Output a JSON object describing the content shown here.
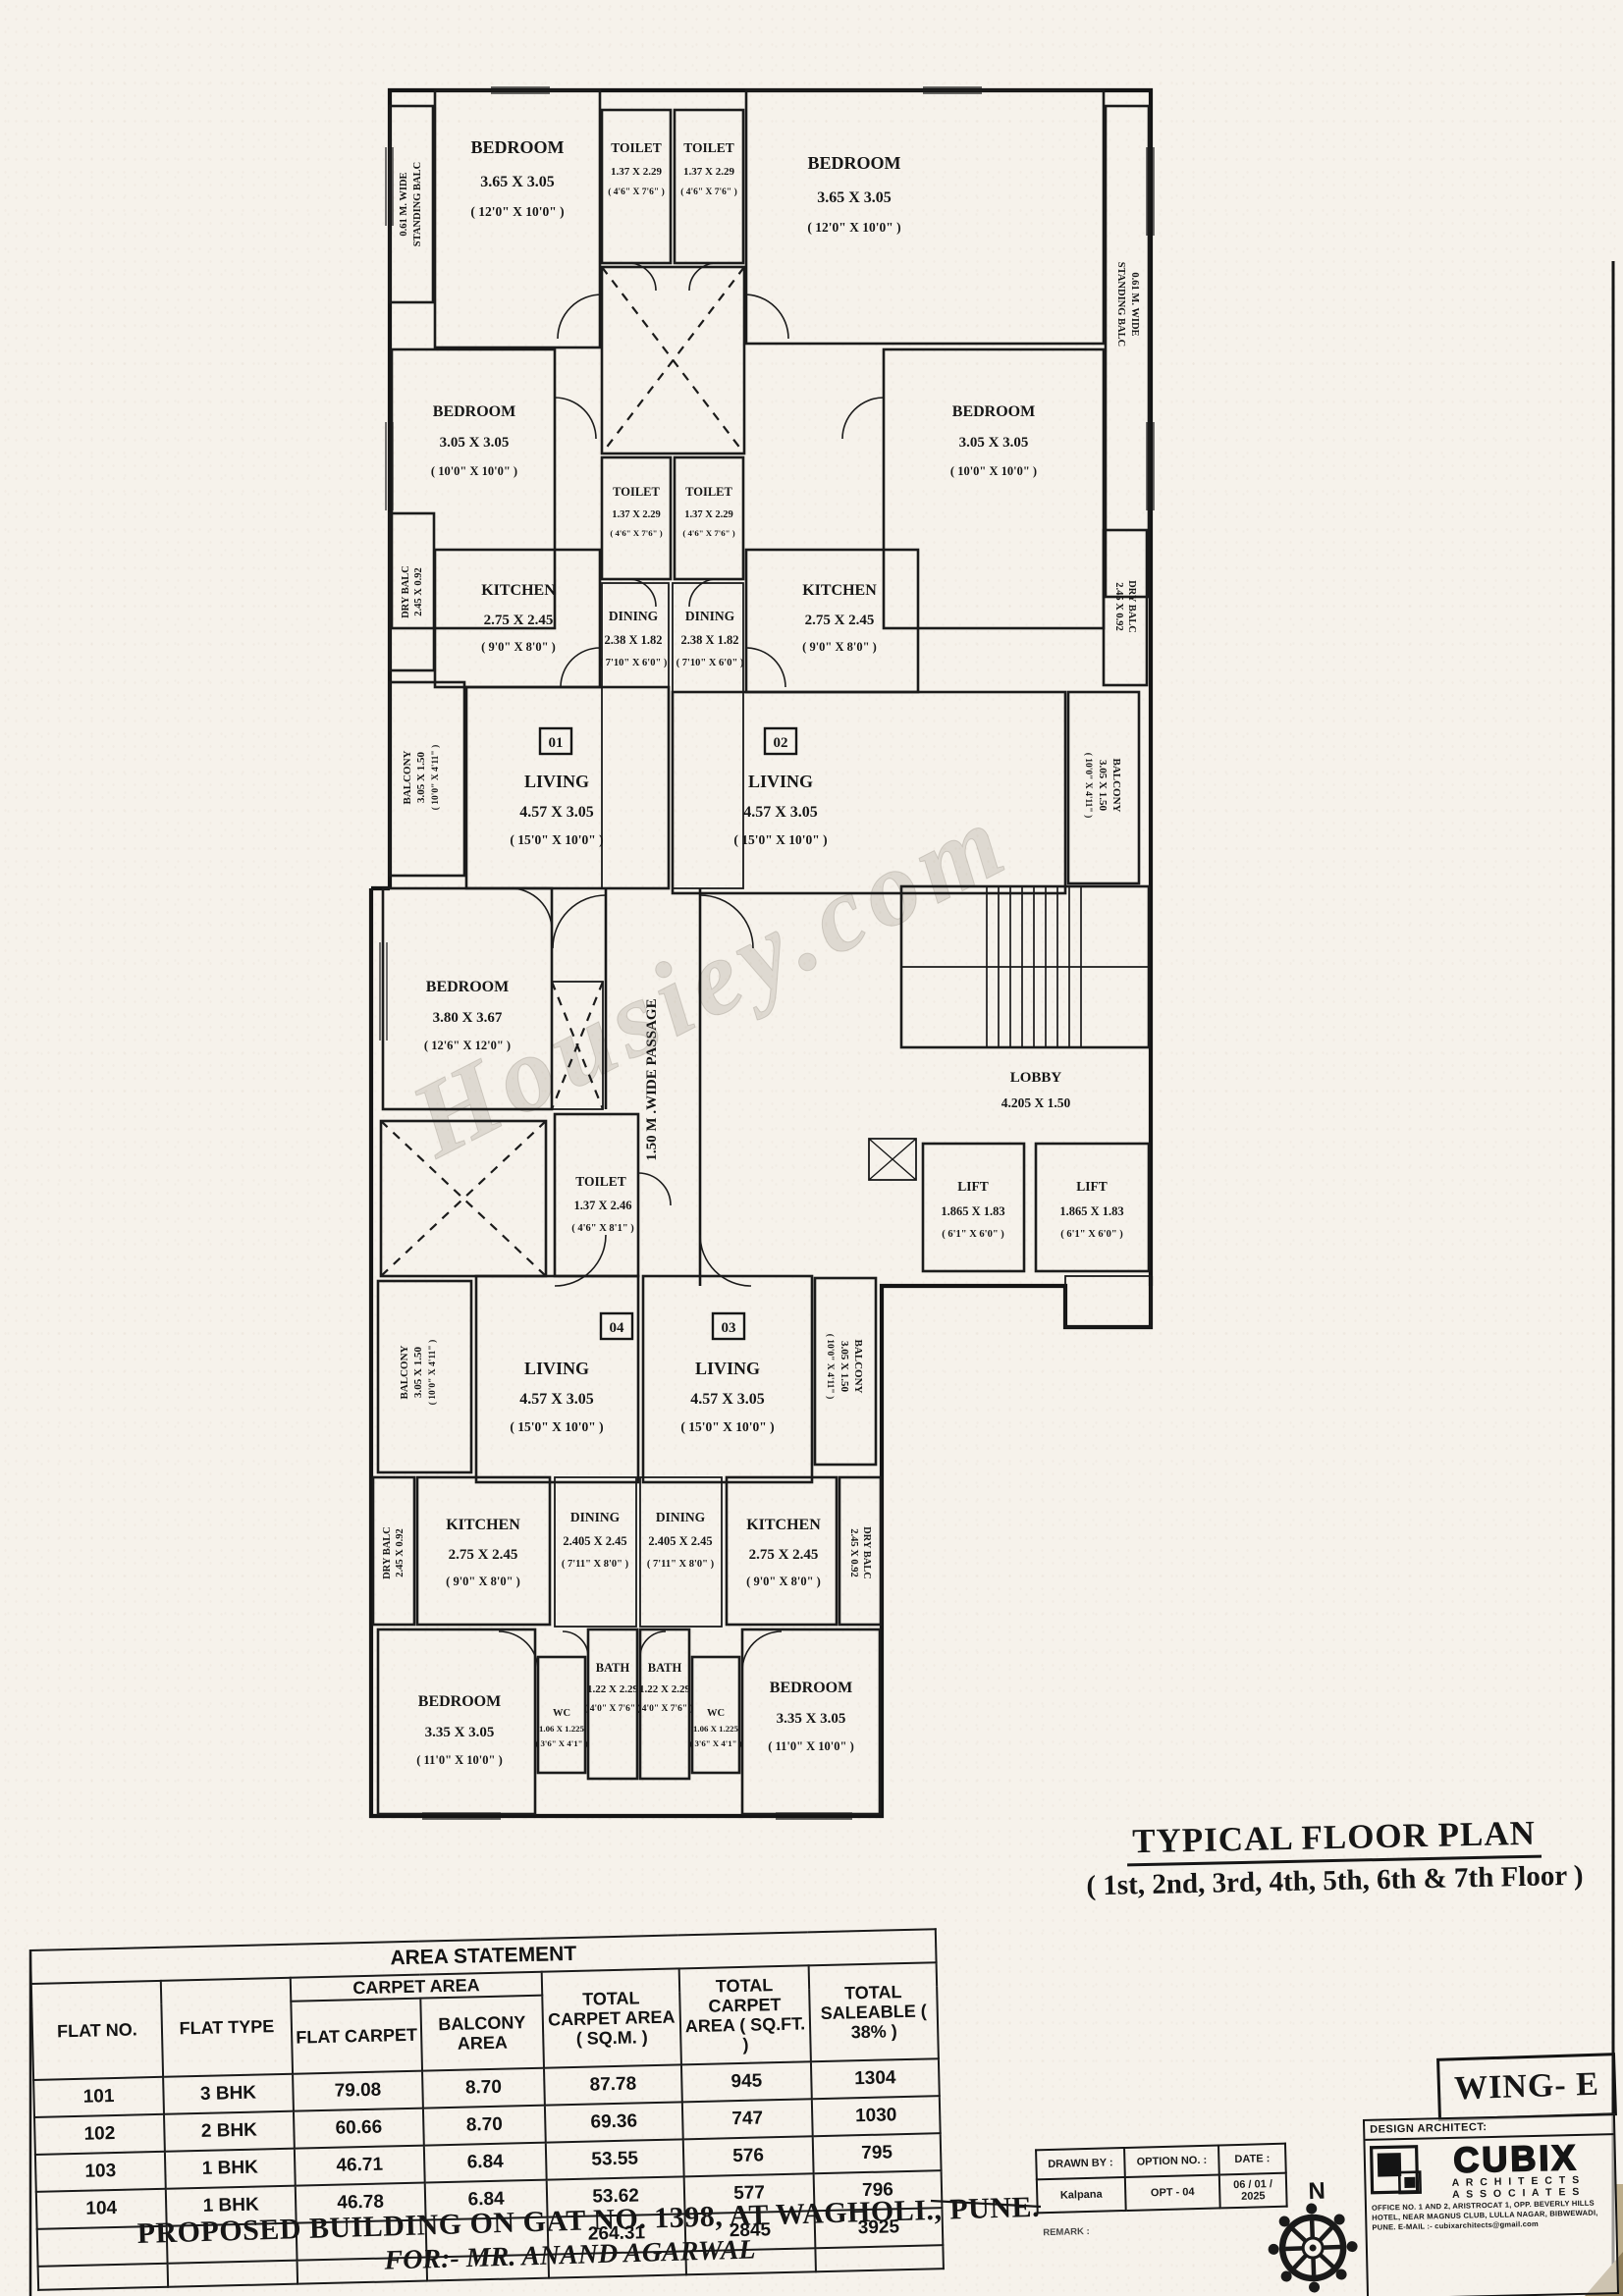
{
  "heading": {
    "title": "TYPICAL FLOOR PLAN",
    "subtitle": "( 1st, 2nd, 3rd, 4th, 5th, 6th & 7th Floor )"
  },
  "footer": {
    "line1": "PROPOSED BUILDING ON GAT NO. 1398, AT WAGHOLI., PUNE.",
    "line2": "FOR:- MR. ANAND AGARWAL"
  },
  "watermark": "Housiey.com",
  "plan": {
    "flat_numbers": {
      "f1": "01",
      "f2": "02",
      "f3": "03",
      "f4": "04"
    },
    "labels": {
      "bedroom_365": [
        "BEDROOM",
        "3.65 X 3.05",
        "( 12'0\" X 10'0\" )"
      ],
      "bedroom_305": [
        "BEDROOM",
        "3.05 X 3.05",
        "( 10'0\" X 10'0\" )"
      ],
      "bedroom_380": [
        "BEDROOM",
        "3.80 X 3.67",
        "( 12'6\" X 12'0\" )"
      ],
      "bedroom_335": [
        "BEDROOM",
        "3.35 X 3.05",
        "( 11'0\" X 10'0\" )"
      ],
      "toilet_small": [
        "TOILET",
        "1.37 X 2.29",
        "( 4'6\" X 7'6\" )"
      ],
      "toilet_mid": [
        "TOILET",
        "1.37 X 2.46",
        "( 4'6\" X 8'1\" )"
      ],
      "kitchen": [
        "KITCHEN",
        "2.75 X 2.45",
        "( 9'0\" X 8'0\" )"
      ],
      "dining_upper": [
        "DINING",
        "2.38 X 1.82",
        "( 7'10\" X 6'0\" )"
      ],
      "dining_lower": [
        "DINING",
        "2.405 X 2.45",
        "( 7'11\" X 8'0\" )"
      ],
      "living": [
        "LIVING",
        "4.57 X 3.05",
        "( 15'0\" X 10'0\" )"
      ],
      "bath": [
        "BATH",
        "1.22 X 2.29",
        "( 4'0\" X 7'6\" )"
      ],
      "wc": [
        "WC",
        "1.06 X 1.225",
        "( 3'6\" X 4'1\" )"
      ],
      "lift": [
        "LIFT",
        "1.865 X 1.83",
        "( 6'1\" X 6'0\" )"
      ],
      "lobby": [
        "LOBBY",
        "4.205 X 1.50"
      ],
      "passage": "1.50 M .WIDE PASSAGE",
      "standing_balc": [
        "0.61 M. WIDE",
        "STANDING BALC"
      ],
      "dry_balc": [
        "DRY BALC",
        "2.45 X 0.92"
      ],
      "balcony": [
        "BALCONY",
        "3.05 X 1.50",
        "( 10'0\" X 4'11\" )"
      ]
    }
  },
  "area_table": {
    "title": "AREA STATEMENT",
    "headers": {
      "flat_no": "FLAT NO.",
      "flat_type": "FLAT TYPE",
      "carpet_area": "CARPET AREA",
      "flat_carpet": "FLAT CARPET",
      "balcony_area": "BALCONY AREA",
      "total_sqm": "TOTAL CARPET AREA ( SQ.M. )",
      "total_sqft": "TOTAL CARPET AREA ( SQ.FT. )",
      "total_saleable": "TOTAL SALEABLE ( 38% )"
    },
    "rows": [
      {
        "flat_no": "101",
        "flat_type": "3 BHK",
        "flat_carpet": "79.08",
        "balcony": "8.70",
        "sqm": "87.78",
        "sqft": "945",
        "saleable": "1304"
      },
      {
        "flat_no": "102",
        "flat_type": "2 BHK",
        "flat_carpet": "60.66",
        "balcony": "8.70",
        "sqm": "69.36",
        "sqft": "747",
        "saleable": "1030"
      },
      {
        "flat_no": "103",
        "flat_type": "1 BHK",
        "flat_carpet": "46.71",
        "balcony": "6.84",
        "sqm": "53.55",
        "sqft": "576",
        "saleable": "795"
      },
      {
        "flat_no": "104",
        "flat_type": "1 BHK",
        "flat_carpet": "46.78",
        "balcony": "6.84",
        "sqm": "53.62",
        "sqft": "577",
        "saleable": "796"
      }
    ],
    "totals": {
      "sqm": "264.31",
      "sqft": "2845",
      "saleable": "3925"
    }
  },
  "title_block": {
    "wing": "WING- E",
    "drawn_by_label": "DRAWN BY :",
    "drawn_by": "Kalpana",
    "option_label": "OPTION NO. :",
    "option": "OPT - 04",
    "date_label": "DATE :",
    "date": "06 / 01 / 2025",
    "remark_label": "REMARK :",
    "north_label": "N",
    "design_architect_label": "DESIGN ARCHITECT:",
    "firm": "CUBIX",
    "firm_line1": "A R C H I T E C T S",
    "firm_line2": "A S S O C I A T E S",
    "address": "OFFICE NO. 1 AND 2, ARISTROCAT 1, OPP. BEVERLY HILLS HOTEL, NEAR MAGNUS CLUB, LULLA NAGAR, BIBWEWADI, PUNE. E-MAIL :- cubixarchitects@gmail.com"
  }
}
